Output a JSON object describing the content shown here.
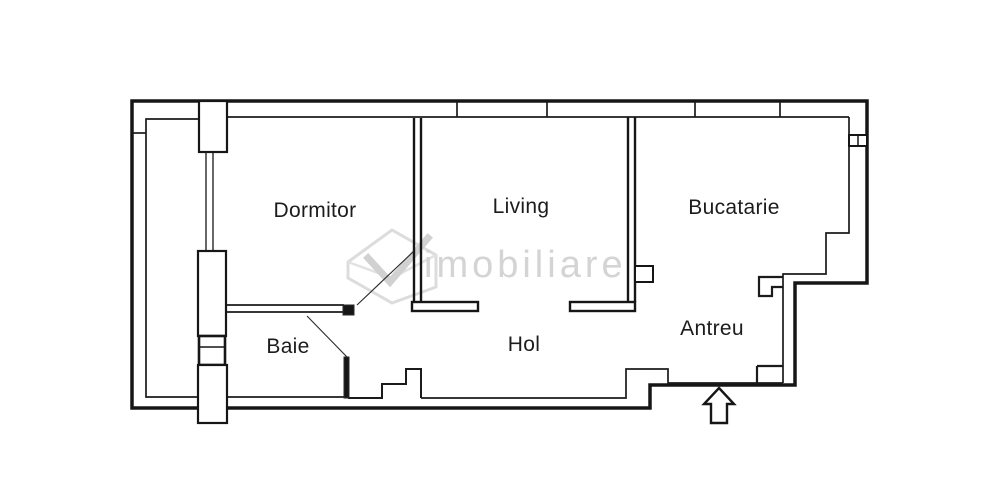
{
  "page": {
    "background_color": "#ffffff",
    "line_color": "#161616",
    "label_color": "#1c1c1c",
    "watermark_color": "#cdcdcd"
  },
  "floorplan": {
    "rooms": [
      {
        "id": "dormitor",
        "label": "Dormitor"
      },
      {
        "id": "living",
        "label": "Living"
      },
      {
        "id": "bucatarie",
        "label": "Bucatarie"
      },
      {
        "id": "baie",
        "label": "Baie"
      },
      {
        "id": "hol",
        "label": "Hol"
      },
      {
        "id": "antreu",
        "label": "Antreu"
      }
    ],
    "entrance_arrow": {
      "direction": "up"
    },
    "watermark": {
      "text": "imobiliare"
    }
  }
}
